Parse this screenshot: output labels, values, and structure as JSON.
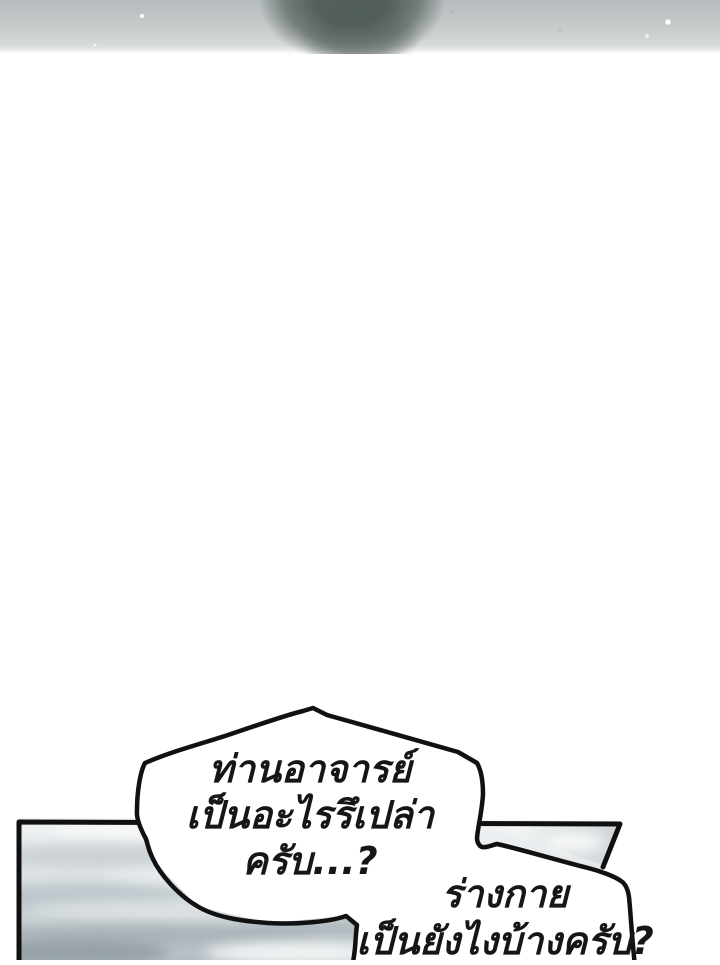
{
  "page": {
    "width": 720,
    "height": 960,
    "background": "#ffffff"
  },
  "top_strip": {
    "alt": "blurred-snow-scene-with-dark-figure",
    "snow_color": "#c2c7c8",
    "figure_color": "#5e6a66"
  },
  "panel": {
    "alt": "cloudy-sky-panel",
    "border_color": "#101010",
    "sky_light": "#f0f2f3",
    "sky_dark": "#b4bec3",
    "cloud_gray": "#a7b1b6"
  },
  "speech": {
    "bubble_fill": "#ffffff",
    "outline_color": "#111111",
    "text_color": "#161616",
    "bubble1": {
      "lines": [
        "ท่านอาจารย์",
        "เป็นอะไรรึเปล่า",
        "ครับ...?"
      ]
    },
    "bubble2": {
      "lines": [
        "ร่างกาย",
        "เป็นยังไงบ้างครับ?"
      ]
    }
  }
}
